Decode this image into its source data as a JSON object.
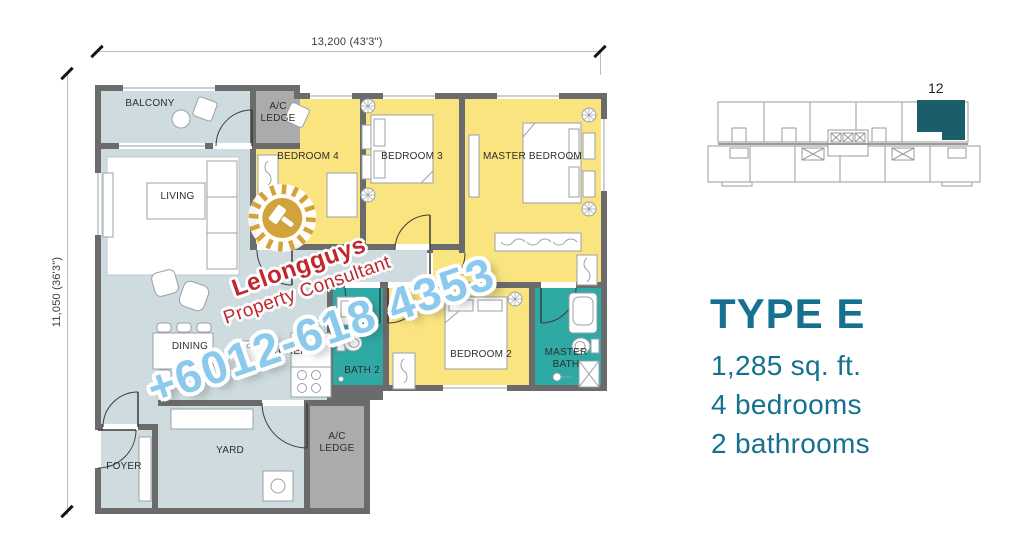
{
  "dimensions": {
    "width_label": "13,200 (43'3\")",
    "height_label": "11,050 (36'3\")"
  },
  "rooms": {
    "balcony": "BALCONY",
    "ac_ledge_top": "A/C LEDGE",
    "bedroom4": "BEDROOM 4",
    "bedroom3": "BEDROOM 3",
    "master_bedroom": "MASTER BEDROOM",
    "living": "LIVING",
    "dining": "DINING",
    "kitchen": "KITCHEN",
    "bath2": "BATH 2",
    "bedroom2": "BEDROOM 2",
    "master_bath": "MASTER BATH",
    "foyer": "FOYER",
    "yard": "YARD",
    "ac_ledge_bottom": "A/C LEDGE"
  },
  "watermark": {
    "brand": "Lelongguys",
    "tagline": "Property Consultant",
    "phone": "+6012-618 4353",
    "brand_color": "#C2272E",
    "phone_color": "#8BCAEC",
    "logo_color": "#D2A23B"
  },
  "keyplan": {
    "unit_label": "12",
    "highlight_color": "#1C5D6C"
  },
  "info": {
    "title": "TYPE E",
    "area": "1,285 sq. ft.",
    "bedrooms": "4 bedrooms",
    "bathrooms": "2 bathrooms",
    "accent_color": "#15718F"
  },
  "palette": {
    "bedroom_fill": "#F9E47F",
    "bath_fill": "#2EA9A3",
    "living_fill": "#CEDCE0",
    "ledge_fill": "#ABABAB",
    "wall": "#6B6B6B"
  }
}
